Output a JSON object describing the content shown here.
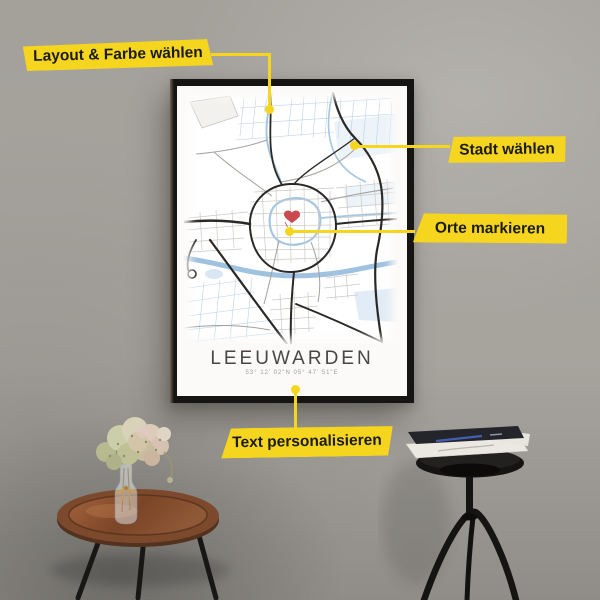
{
  "scene": {
    "wall_color": "#a7a49e",
    "accent_yellow": "#f5d51d"
  },
  "annotations": [
    {
      "id": "layout",
      "label": "Layout & Farbe wählen"
    },
    {
      "id": "city",
      "label": "Stadt wählen"
    },
    {
      "id": "places",
      "label": "Orte markieren"
    },
    {
      "id": "text",
      "label": "Text personalisieren"
    }
  ],
  "poster": {
    "title": "LEEUWARDEN",
    "coordinates": "53° 12' 02\"N 05° 47' 51\"E",
    "frame_color": "#171513",
    "map_colors": {
      "background": "#ffffff",
      "water": "#a5c6e2",
      "roads_major": "#2b2926",
      "roads_minor": "#ccc9c4",
      "marker_heart": "#c94b50"
    }
  }
}
